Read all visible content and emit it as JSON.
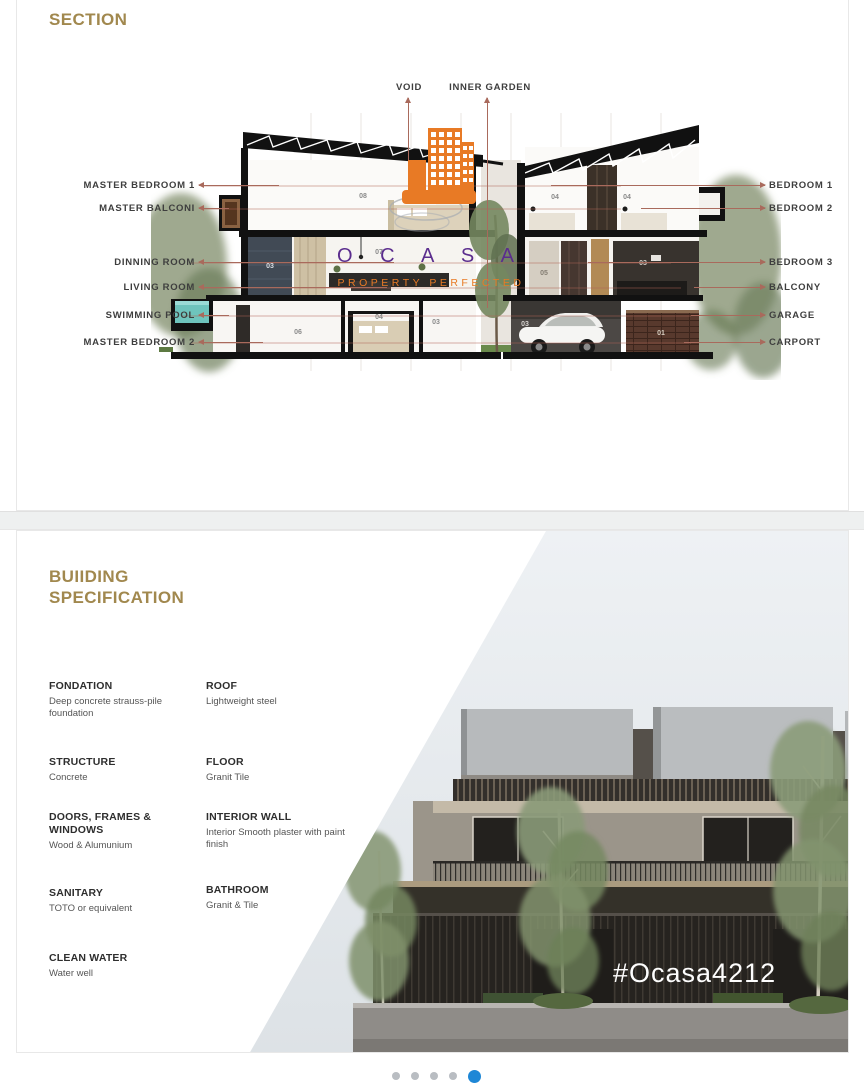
{
  "section_panel": {
    "title": "SECTION",
    "title_color": "#a1884e",
    "arrow_color": "#a96a5c",
    "top_labels": [
      "VOID",
      "INNER GARDEN"
    ],
    "left_labels": [
      "MASTER BEDROOM 1",
      "MASTER BALCONI",
      "DINNING ROOM",
      "LIVING ROOM",
      "SWIMMING POOL",
      "MASTER BEDROOM 2"
    ],
    "right_labels": [
      "BEDROOM 1",
      "BEDROOM 2",
      "BEDROOM 3",
      "BALCONY",
      "GARAGE",
      "CARPORT"
    ],
    "room_numbers": {
      "lh_upper": "08",
      "lh_wall": "03",
      "lh_living": "07",
      "lh_lower_left": "06",
      "lh_lower_mid": "04",
      "lh_lower_right": "03",
      "rh_upper_left": "04",
      "rh_upper_right": "04",
      "rh_mid_left": "05",
      "rh_mid_right": "03",
      "rh_garage": "03",
      "rh_carport": "01"
    }
  },
  "watermark": {
    "brand_letters": "O C A S A",
    "tagline": "PROPERTY PERFECTED",
    "brand_color": "#5b2d8e",
    "accent_color": "#e87a25"
  },
  "spec_panel": {
    "title_line1": "BUIIDING",
    "title_line2": "SPECIFICATION",
    "items_left": [
      {
        "label": "FONDATION",
        "value": "Deep concrete strauss-pile foundation"
      },
      {
        "label": "STRUCTURE",
        "value": "Concrete"
      },
      {
        "label": "DOORS, FRAMES & WINDOWS",
        "value": "Wood & Alumunium"
      },
      {
        "label": "SANITARY",
        "value": "TOTO or equivalent"
      },
      {
        "label": "CLEAN WATER",
        "value": "Water well"
      }
    ],
    "items_right": [
      {
        "label": "ROOF",
        "value": "Lightweight steel"
      },
      {
        "label": "FLOOR",
        "value": "Granit Tile"
      },
      {
        "label": "INTERIOR WALL",
        "value": "Interior Smooth plaster with paint finish"
      },
      {
        "label": "BATHROOM",
        "value": "Granit & Tile"
      }
    ],
    "hashtag": "#Ocasa4212"
  },
  "pagination": {
    "dot_count": 5,
    "active_index": 4,
    "dot_color": "#b9bdc2",
    "active_color": "#1e87d6"
  }
}
